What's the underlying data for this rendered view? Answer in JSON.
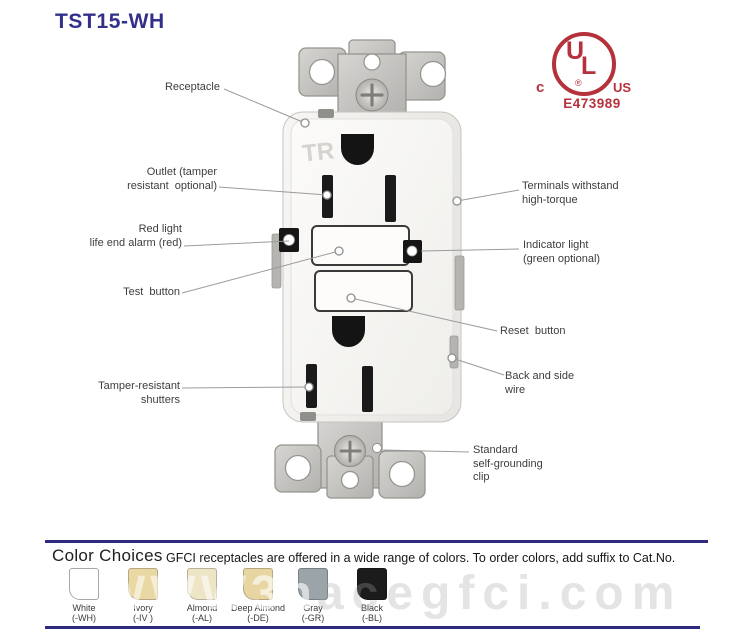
{
  "title": "TST15-WH",
  "certification": {
    "c": "c",
    "ul_u": "U",
    "ul_l": "L",
    "reg": "®",
    "us": "US",
    "file_number": "E473989",
    "color": "#b5323c"
  },
  "device": {
    "tr_marking": "TR"
  },
  "callouts": {
    "receptacle": "Receptacle",
    "outlet": "Outlet (tamper\nresistant  optional)",
    "red_light": "Red light\nlife end alarm (red)",
    "test_button": "Test  button",
    "tamper_shutters": "Tamper-resistant\nshutters",
    "terminals": "Terminals withstand\nhigh-torque",
    "indicator_light": "Indicator light\n(green optional)",
    "reset_button": "Reset  button",
    "back_side_wire": "Back and side\nwire",
    "grounding_clip": "Standard\nself-grounding\nclip"
  },
  "color_choices": {
    "heading": "Color Choices",
    "description": "GFCI receptacles are offered in a wide range of colors. To order colors, add suffix to Cat.No.",
    "accent_color": "#2e2b7e",
    "colors": [
      {
        "name": "White",
        "suffix": "(-WH)",
        "hex": "#ffffff"
      },
      {
        "name": "Ivory",
        "suffix": "(-IV )",
        "hex": "#e9d8a4"
      },
      {
        "name": "Almond",
        "suffix": "(-AL)",
        "hex": "#ede5c6"
      },
      {
        "name": "Deep Almond",
        "suffix": "(-DE)",
        "hex": "#e8d6a2"
      },
      {
        "name": "Gray",
        "suffix": "(-GR)",
        "hex": "#9aa4a9"
      },
      {
        "name": "Black",
        "suffix": "(-BL)",
        "hex": "#1b1b1b"
      }
    ]
  },
  "watermark": {
    "left": "WWW",
    "mid": "3n",
    "right": "acegfci.com"
  }
}
